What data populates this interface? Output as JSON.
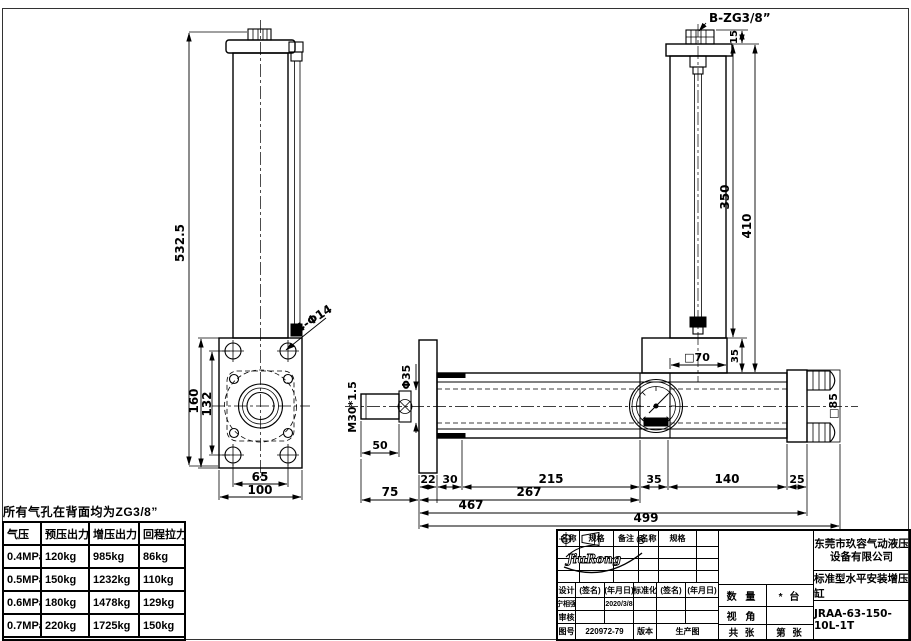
{
  "drawing": {
    "note": "所有气孔在背面均为ZG3/8”",
    "port_b": "B-ZG3/8”",
    "holes_label": "4-Φ14",
    "rod_thread": "M30*1.5",
    "rod_dia": "Φ35",
    "dims": {
      "total_height": "532.5",
      "plate_height": "160",
      "hole_span_v": "132",
      "hole_span_h": "65",
      "plate_width": "100",
      "port_offset": "15",
      "tube_length": "350",
      "cylinder_length": "410",
      "block_height": "35",
      "square70": "□70",
      "square85": "□85",
      "rod_extend": "50",
      "seg22": "22",
      "seg30": "30",
      "seg215": "215",
      "seg35": "35",
      "seg140": "140",
      "seg25": "25",
      "rod_total": "75",
      "mid267": "267",
      "len467": "467",
      "len499": "499"
    }
  },
  "spec_table": {
    "headers": [
      "气压",
      "预压出力",
      "增压出力",
      "回程拉力"
    ],
    "rows": [
      [
        "0.4MPa",
        "120kg",
        "985kg",
        "86kg"
      ],
      [
        "0.5MPa",
        "150kg",
        "1232kg",
        "110kg"
      ],
      [
        "0.6MPa",
        "180kg",
        "1478kg",
        "129kg"
      ],
      [
        "0.7MPa",
        "220kg",
        "1725kg",
        "150kg"
      ]
    ],
    "note": "建议：回程负载低于回程拉力50%."
  },
  "title_block": {
    "parts_headers": [
      "名称",
      "规格",
      "备注",
      "名称",
      "规格",
      "备注"
    ],
    "sign_headers": [
      "设计",
      "(签名)",
      "(年月日)",
      "标准化",
      "(签名)",
      "(年月日)"
    ],
    "designer": "宁相强",
    "design_date": "2020/3/8",
    "audit_label": "审核",
    "drawing_no_label": "图号",
    "drawing_no": "220972-79",
    "version_label": "版本",
    "version_value": "生产图",
    "qty_label": "数 量",
    "qty_value": "* 台",
    "view_label": "视 角",
    "sheets_total": "共 张",
    "sheet_no": "第 张",
    "logo_text": "JiuRong",
    "logo_reg": "®",
    "company_line1": "东莞市玖容气动液压",
    "company_line2": "设备有限公司",
    "product": "标准型水平安装增压缸",
    "model": "JRAA-63-150-10L-1T"
  }
}
